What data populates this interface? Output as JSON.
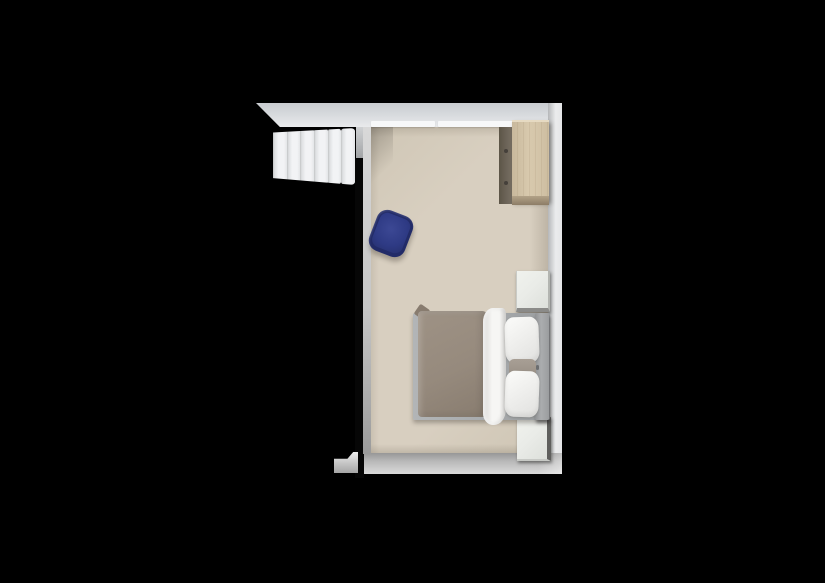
{
  "scene": {
    "type": "3d-floorplan-top-down-render",
    "room_label": "bedroom",
    "items": [
      {
        "name": "staircase",
        "steps": 6
      },
      {
        "name": "wardrobe",
        "handles": 2
      },
      {
        "name": "ottoman"
      },
      {
        "name": "nightstand-top"
      },
      {
        "name": "nightstand-bottom"
      },
      {
        "name": "double-bed",
        "pillows": 2,
        "lumbar_cushions": 1
      }
    ]
  },
  "colors": {
    "background": "#000000",
    "floor": "#d8cfc0",
    "wall_top_light": "#e9eaec",
    "wall_top_dark": "#c9ccd0",
    "baseboard": "#f7f8f9",
    "wall_right_light": "#ebeced",
    "wall_right_dark": "#b5b7b9",
    "wall_bottom_dark": "#979797",
    "wall_bottom_light": "#dadada",
    "wall_black": "#060606",
    "wall_face": "#c6c6c6",
    "stub_light": "#ededed",
    "stub_dark": "#a5a5a5",
    "step_light": "#f2f3f5",
    "step_shade": "#d5d7d9",
    "wood_light": "#d8c9ad",
    "wood_mid": "#c8b89c",
    "wood_dark": "#8d7d66",
    "wood_highlight": "#e6dac2",
    "wardrobe_side": "#6e665a",
    "wardrobe_handle": "#45403a",
    "bed_frame": "#a8abad",
    "duvet_light": "#9e9285",
    "duvet_dark": "#887c6f",
    "sheet_white": "#f6f6f4",
    "sheet_shade": "#d9d8d6",
    "pillow_white": "#f9f9f7",
    "pillow_shade": "#e3e3e1",
    "cushion": "#a89f95",
    "headboard_light": "#abadaf",
    "headboard_dark": "#919395",
    "tuft": "#6b6d6f",
    "nightstand_face": "#eaece8",
    "nightstand_edge": "#8b8b89",
    "nightstand_edge_dark": "#5f5f5d",
    "ottoman_rim": "#222b68",
    "ottoman_face": "#2e3a84",
    "ottoman_highlight": "#3c4894"
  }
}
